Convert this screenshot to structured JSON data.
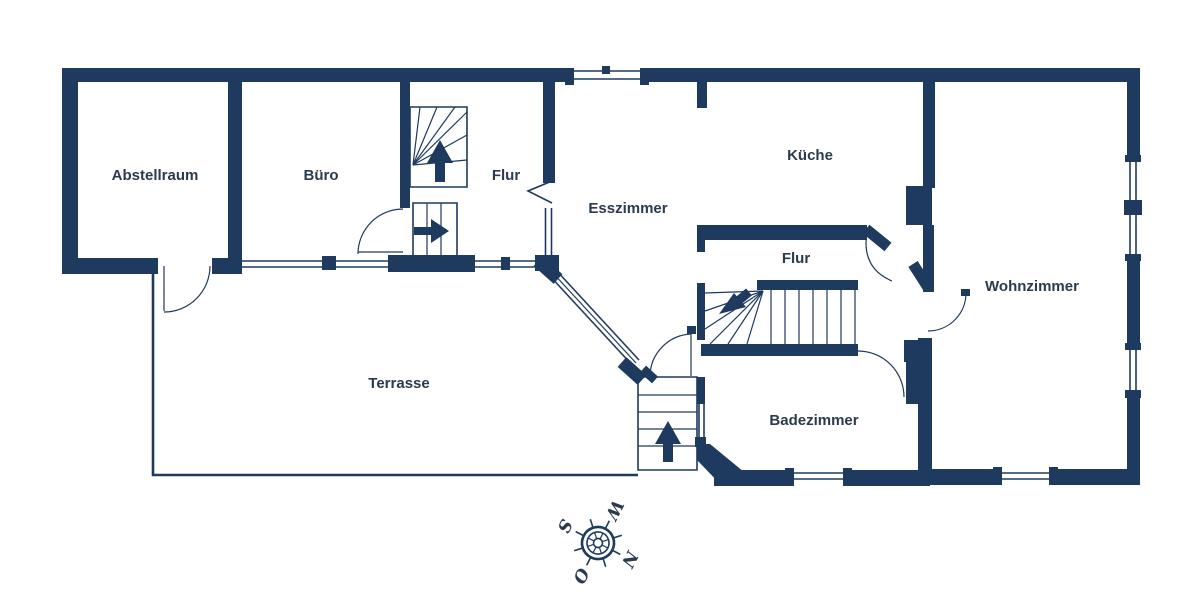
{
  "plan": {
    "rooms": [
      {
        "name": "Abstellraum"
      },
      {
        "name": "Büro"
      },
      {
        "name": "Flur"
      },
      {
        "name": "Esszimmer"
      },
      {
        "name": "Küche"
      },
      {
        "name": "Flur"
      },
      {
        "name": "Wohnzimmer"
      },
      {
        "name": "Badezimmer"
      },
      {
        "name": "Terrasse"
      }
    ],
    "compass": {
      "n": "N",
      "s": "S",
      "w": "W",
      "o": "O"
    },
    "icons": [
      "stairs-up-arrow",
      "stairs-down-arrow",
      "stairs-right-arrow",
      "compass-rose"
    ],
    "colors": {
      "wall": "#1e3a5e",
      "text": "#2b3b4e",
      "background": "#ffffff"
    }
  }
}
